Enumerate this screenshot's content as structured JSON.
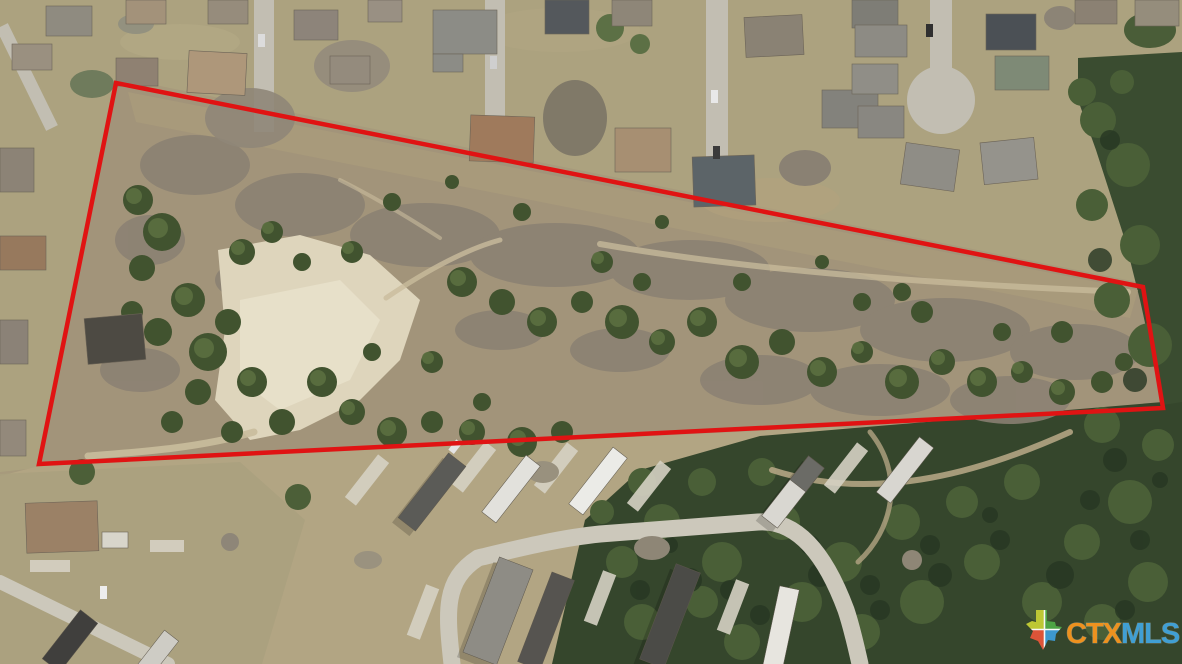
{
  "meta": {
    "alt": "Aerial drone photograph of a wooded acreage parcel outlined in red, bordered by a suburban neighborhood on the north and a manufactured home community on the south"
  },
  "regions": {
    "neighborhood": {
      "label": "suburban neighborhood",
      "fill": "#aca27f"
    },
    "property": {
      "label": "wooded acreage parcel",
      "fill": "#a2947a"
    },
    "park": {
      "label": "manufactured home community",
      "fill": "#b2a583"
    },
    "forest_right": {
      "label": "dense woodland east",
      "fill": "#3a4c30"
    },
    "forest_bottom": {
      "label": "dense woodland south",
      "fill": "#35462c"
    },
    "clearing": {
      "label": "caliche clearing",
      "fill": "#ded5bc"
    }
  },
  "boundary": {
    "points": "116,83 1143,287 1163,408 39,464",
    "color": "#e01313",
    "width": "4.5"
  },
  "watermark": {
    "text_primary": "CTX",
    "text_secondary": "MLS",
    "color_primary": "#f5941f",
    "color_secondary": "#41a3dc",
    "icon": "texas-state-icon",
    "icon_colors": {
      "nw": "#c3cd36",
      "ne": "#4fa746",
      "sw": "#e4553a",
      "se": "#3e9cd6"
    }
  }
}
